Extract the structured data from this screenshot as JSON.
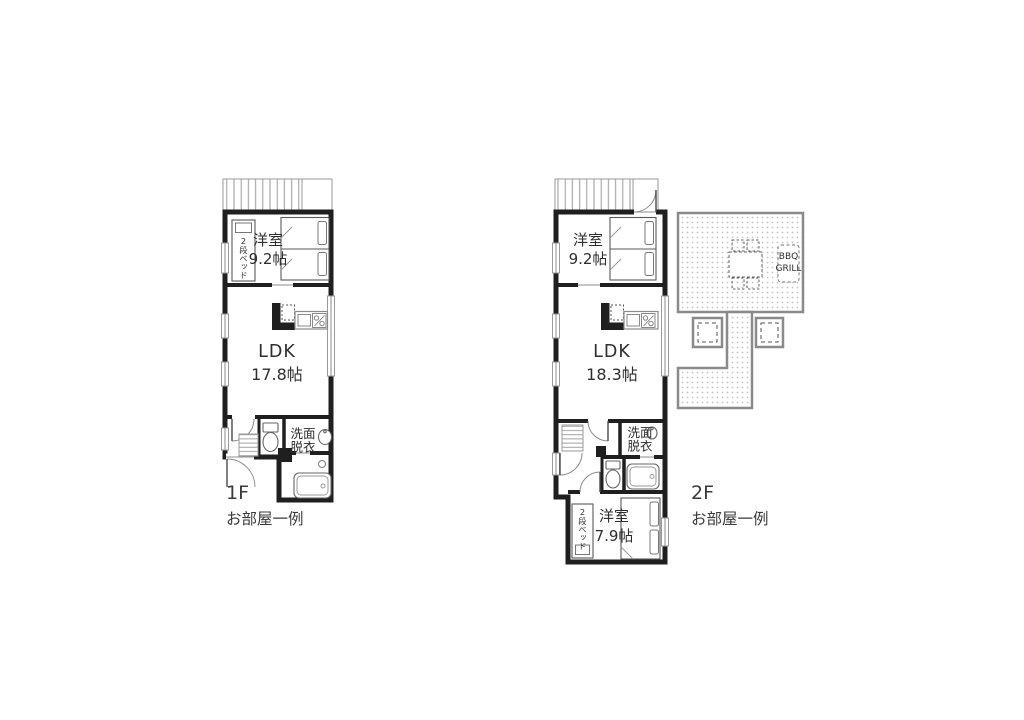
{
  "document": {
    "type": "floor-plan-sheet",
    "background": "#ffffff"
  },
  "floor1": {
    "label": "1F",
    "caption": "お部屋一例",
    "bedroom": {
      "name": "洋室",
      "size": "9.2帖"
    },
    "ldk": {
      "name": "LDK",
      "size": "17.8帖"
    },
    "washroom": {
      "line1": "洗面",
      "line2": "脱衣"
    },
    "bunk_bed": "2段ベッド"
  },
  "floor2": {
    "label": "2F",
    "caption": "お部屋一例",
    "bedroom": {
      "name": "洋室",
      "size": "9.2帖"
    },
    "ldk": {
      "name": "LDK",
      "size": "18.3帖"
    },
    "washroom": {
      "line1": "洗面",
      "line2": "脱衣"
    },
    "bunk_bed": "2段ベッド",
    "bedroom2": {
      "name": "洋室",
      "size": "7.9帖"
    },
    "terrace": {
      "bbq_line1": "BBQ",
      "bbq_line2": "GRILL"
    }
  },
  "colors": {
    "wall": "#1f1f1f",
    "thin_line": "#8c8c8c",
    "terrace_border": "#8a8a8a",
    "dots": "#c4c4c4",
    "text": "#333333"
  }
}
